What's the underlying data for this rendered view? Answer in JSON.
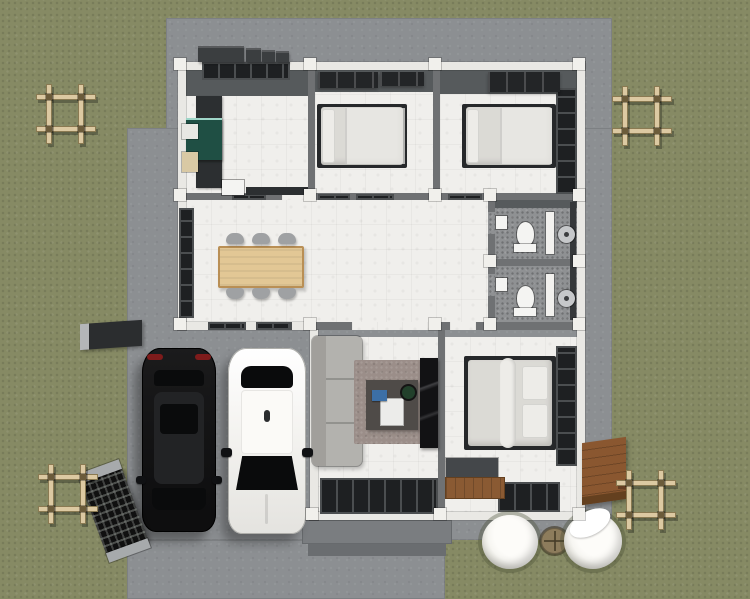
{
  "scene": {
    "type": "floor-plan-3d-render",
    "view": "top-down",
    "description": "single-storey-house-with-carport-two-cars-and-landscaped-yard"
  },
  "colors": {
    "grass": "#868a64",
    "concrete": "#8c8f92",
    "porch": "#7a7d80",
    "porch_dark": "#6a6d70",
    "wall_white": "#e9e8e4",
    "wall_gray": "#6f7173",
    "wall_face": "#565a5c",
    "wall_cap": "#f1f0ec",
    "floor_tile": "#f0efec",
    "floor_bath": "#8f9193",
    "window_dark": "#1e2022",
    "window_frame": "#4b4e50",
    "counter_dark": "#2c2f31",
    "island_teal": "#1f4f44",
    "island_glass": "#9fd6c8",
    "appliance_white": "#e8e7e3",
    "appliance_beige": "#d9c9a4",
    "bed_frame": "#26282a",
    "bed_sheet": "#dbdad5",
    "bed_pillow": "#edece8",
    "wardrobe": "#232527",
    "table_wood": "#e2c795",
    "table_edge": "#b98f55",
    "chair": "#9fa1a3",
    "sofa": "#b3b2ae",
    "sofa_dark": "#a19f9b",
    "rug": "#9b8e89",
    "coffee_table": "#4f4b48",
    "tray_white": "#ececea",
    "plant_green": "#22402b",
    "book_blue": "#3c6fa6",
    "tv_console": "#121214",
    "toilet_white": "#f4f4f2",
    "shower_metal": "#c6c8ca",
    "bath_wall_dark": "#35383a",
    "door_white": "#f2f1ee",
    "closet_dark": "#44474a",
    "car_black": "#161617",
    "car_black_roof": "#222325",
    "car_glass": "#0a0b0c",
    "taillight_red": "#7e1b1b",
    "car_white": "#f4f3f0",
    "car_white_line": "#aeaeaa",
    "pergola_wood": "#dcc9a2",
    "pergola_dark": "#8a7a52",
    "pergola_post": "#6b5b3a",
    "deck_wood": "#8a5730",
    "deck_edge": "#64401f",
    "bench_wood": "#8a5a33",
    "gate_dark": "#101010",
    "gate_post": "#a7aaac",
    "stub_dark": "#2b2d2f",
    "sphere_white": "#f7f6f2",
    "sphere_shade": "#9c9c94",
    "stone_brown": "#8d7c5c",
    "ac_unit": "#3b3e40"
  },
  "house": {
    "rooms": [
      {
        "name": "kitchen",
        "furniture": [
          "l-shaped-dark-counter",
          "teal-island-counter",
          "refrigerator",
          "water-heater-box",
          "sink"
        ]
      },
      {
        "name": "bedroom-top-middle",
        "furniture": [
          "double-bed",
          "wardrobe",
          "top-window"
        ]
      },
      {
        "name": "bedroom-top-right",
        "furniture": [
          "double-bed",
          "wardrobe",
          "side-window-wall"
        ]
      },
      {
        "name": "dining-room",
        "furniture": [
          "wooden-dining-table",
          "six-gray-chairs",
          "tall-side-window"
        ]
      },
      {
        "name": "hallway",
        "furniture": [
          "transom-windows"
        ]
      },
      {
        "name": "bathroom-upper",
        "furniture": [
          "toilet",
          "wall-sink",
          "door-leaf",
          "shower-head"
        ]
      },
      {
        "name": "bathroom-lower",
        "furniture": [
          "toilet",
          "wall-sink",
          "door-leaf",
          "shower-head"
        ]
      },
      {
        "name": "living-room",
        "furniture": [
          "gray-sofa",
          "area-rug",
          "coffee-table",
          "white-tray",
          "potted-plant",
          "blue-book",
          "tv-console",
          "glass-doors"
        ]
      },
      {
        "name": "bedroom-bottom-right",
        "furniture": [
          "double-bed",
          "dark-closet",
          "wooden-bench",
          "side-window-wall",
          "bottom-window"
        ]
      }
    ]
  },
  "exterior": {
    "vehicles": [
      {
        "name": "black-suv",
        "color_key": "car_black"
      },
      {
        "name": "white-sedan",
        "color_key": "car_white"
      }
    ],
    "objects": [
      "concrete-pad",
      "carport-driveway",
      "front-porch-steps",
      "pergola-frame-top-left",
      "pergola-frame-top-right",
      "pergola-frame-bottom-left",
      "pergola-frame-bottom-right",
      "metal-gate-panel",
      "fence-wall-stub",
      "ac-units-row",
      "wooden-deck",
      "sphere-planter-left",
      "sphere-planter-right",
      "round-stepping-stone"
    ]
  }
}
